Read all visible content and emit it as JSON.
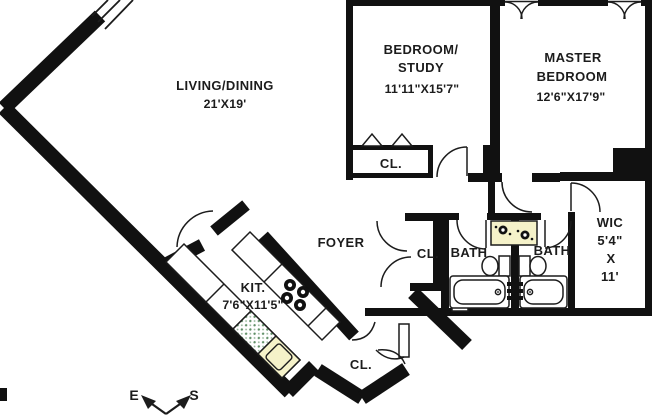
{
  "plan": {
    "title": "apartment-floor-plan",
    "rooms": {
      "living": {
        "name": "LIVING/DINING",
        "dims": "21'X19'"
      },
      "bedroom_study": {
        "name_line1": "BEDROOM/",
        "name_line2": "STUDY",
        "dims": "11'11\"X15'7\""
      },
      "master": {
        "name_line1": "MASTER",
        "name_line2": "BEDROOM",
        "dims": "12'6\"X17'9\""
      },
      "kitchen": {
        "name": "KIT.",
        "dims": "7'6\"X11'5\""
      },
      "foyer": {
        "name": "FOYER"
      },
      "bath_left": {
        "name": "BATH"
      },
      "bath_right": {
        "name": "BATH"
      },
      "wic": {
        "line1": "WIC",
        "line2": "5'4\"",
        "line3": "X",
        "line4": "11'"
      },
      "closet_bedroom": {
        "name": "CL."
      },
      "closet_foyer": {
        "name": "CL."
      },
      "closet_hall": {
        "name": "CL."
      }
    },
    "compass": {
      "east": "E",
      "south": "S"
    },
    "colors": {
      "wall": "#111111",
      "line": "#1c1c1c",
      "sink": "#f5f2c9",
      "dwdot": "#5f8f66",
      "paper": "#ffffff"
    }
  }
}
